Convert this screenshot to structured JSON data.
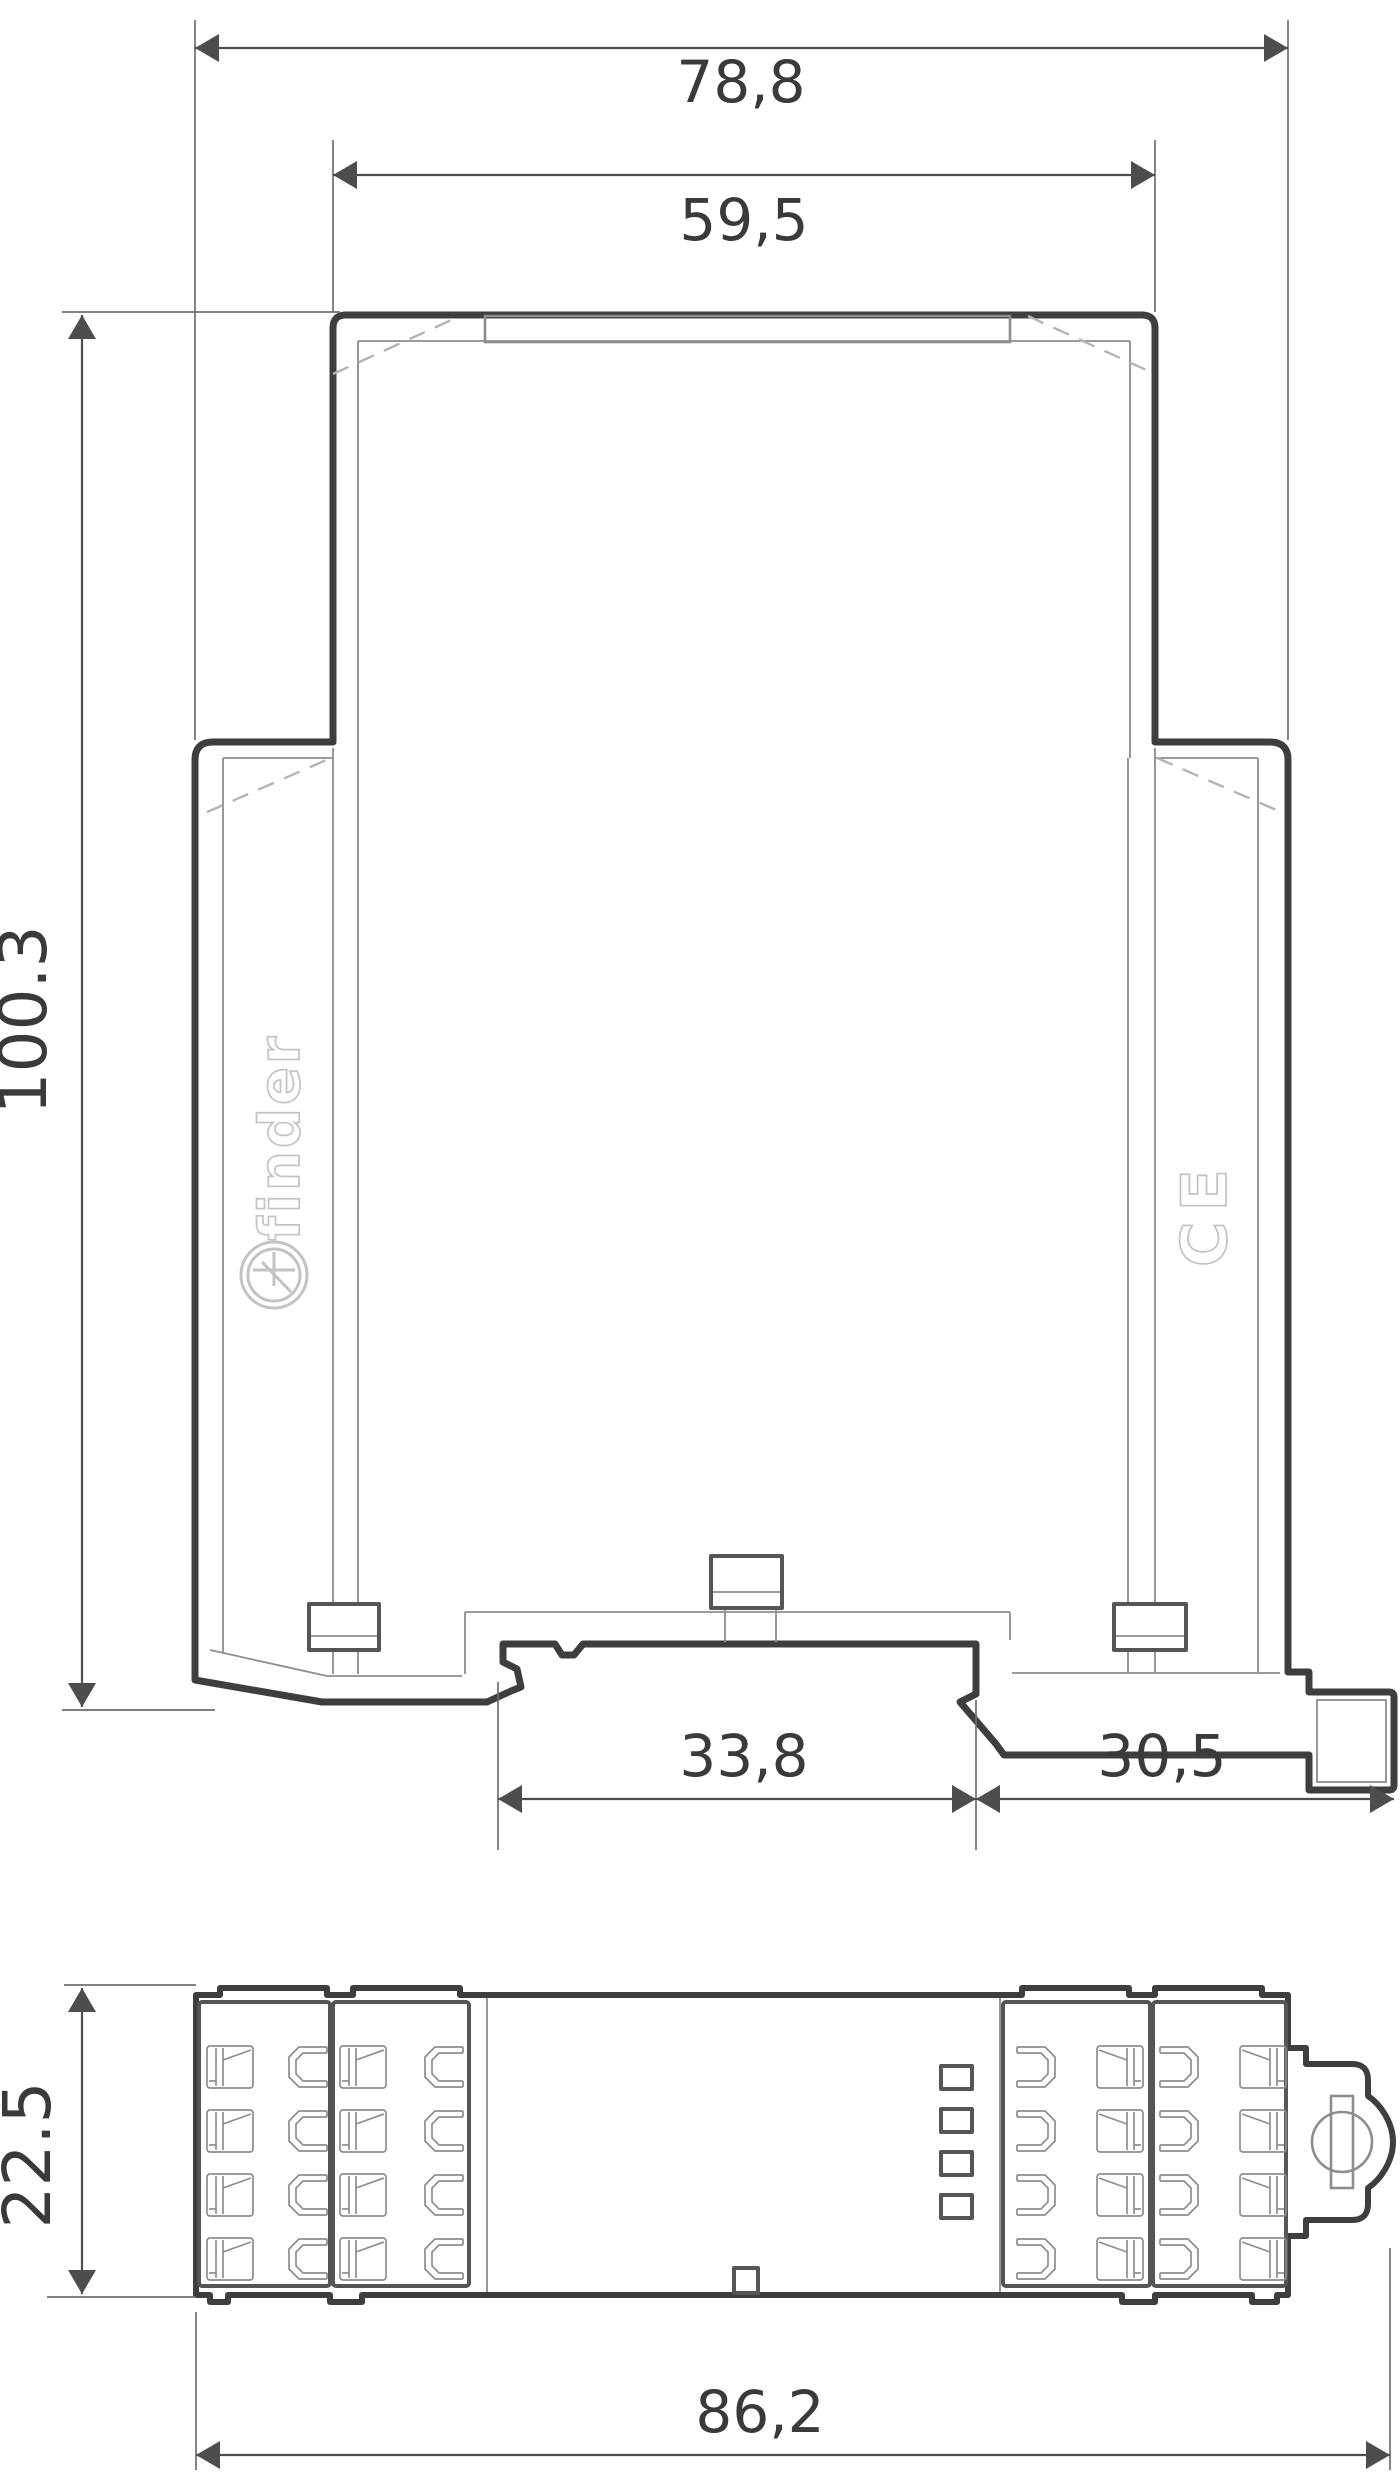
{
  "page": {
    "title": "DIN-rail relay module dimensional drawing"
  },
  "front_view": {
    "dim_width_overall": "78,8",
    "dim_width_upper": "59,5",
    "dim_height_overall": "100.3",
    "dim_din_notch": "33,8",
    "dim_din_clip": "30,5",
    "brand_logo": "finder",
    "ce_mark": "CE"
  },
  "top_view": {
    "dim_depth": "22.5",
    "dim_width_overall": "86,2"
  },
  "colors": {
    "bg": "#ffffff",
    "outline": "#3e3e3e",
    "medium": "#555555",
    "thin": "#8d8d8d",
    "ext": "#6f6f6f",
    "dim": "#4d4d4d",
    "dashed": "#b4b4b4",
    "ink": "#3a3a3a",
    "logo": "#c3c3c3"
  }
}
